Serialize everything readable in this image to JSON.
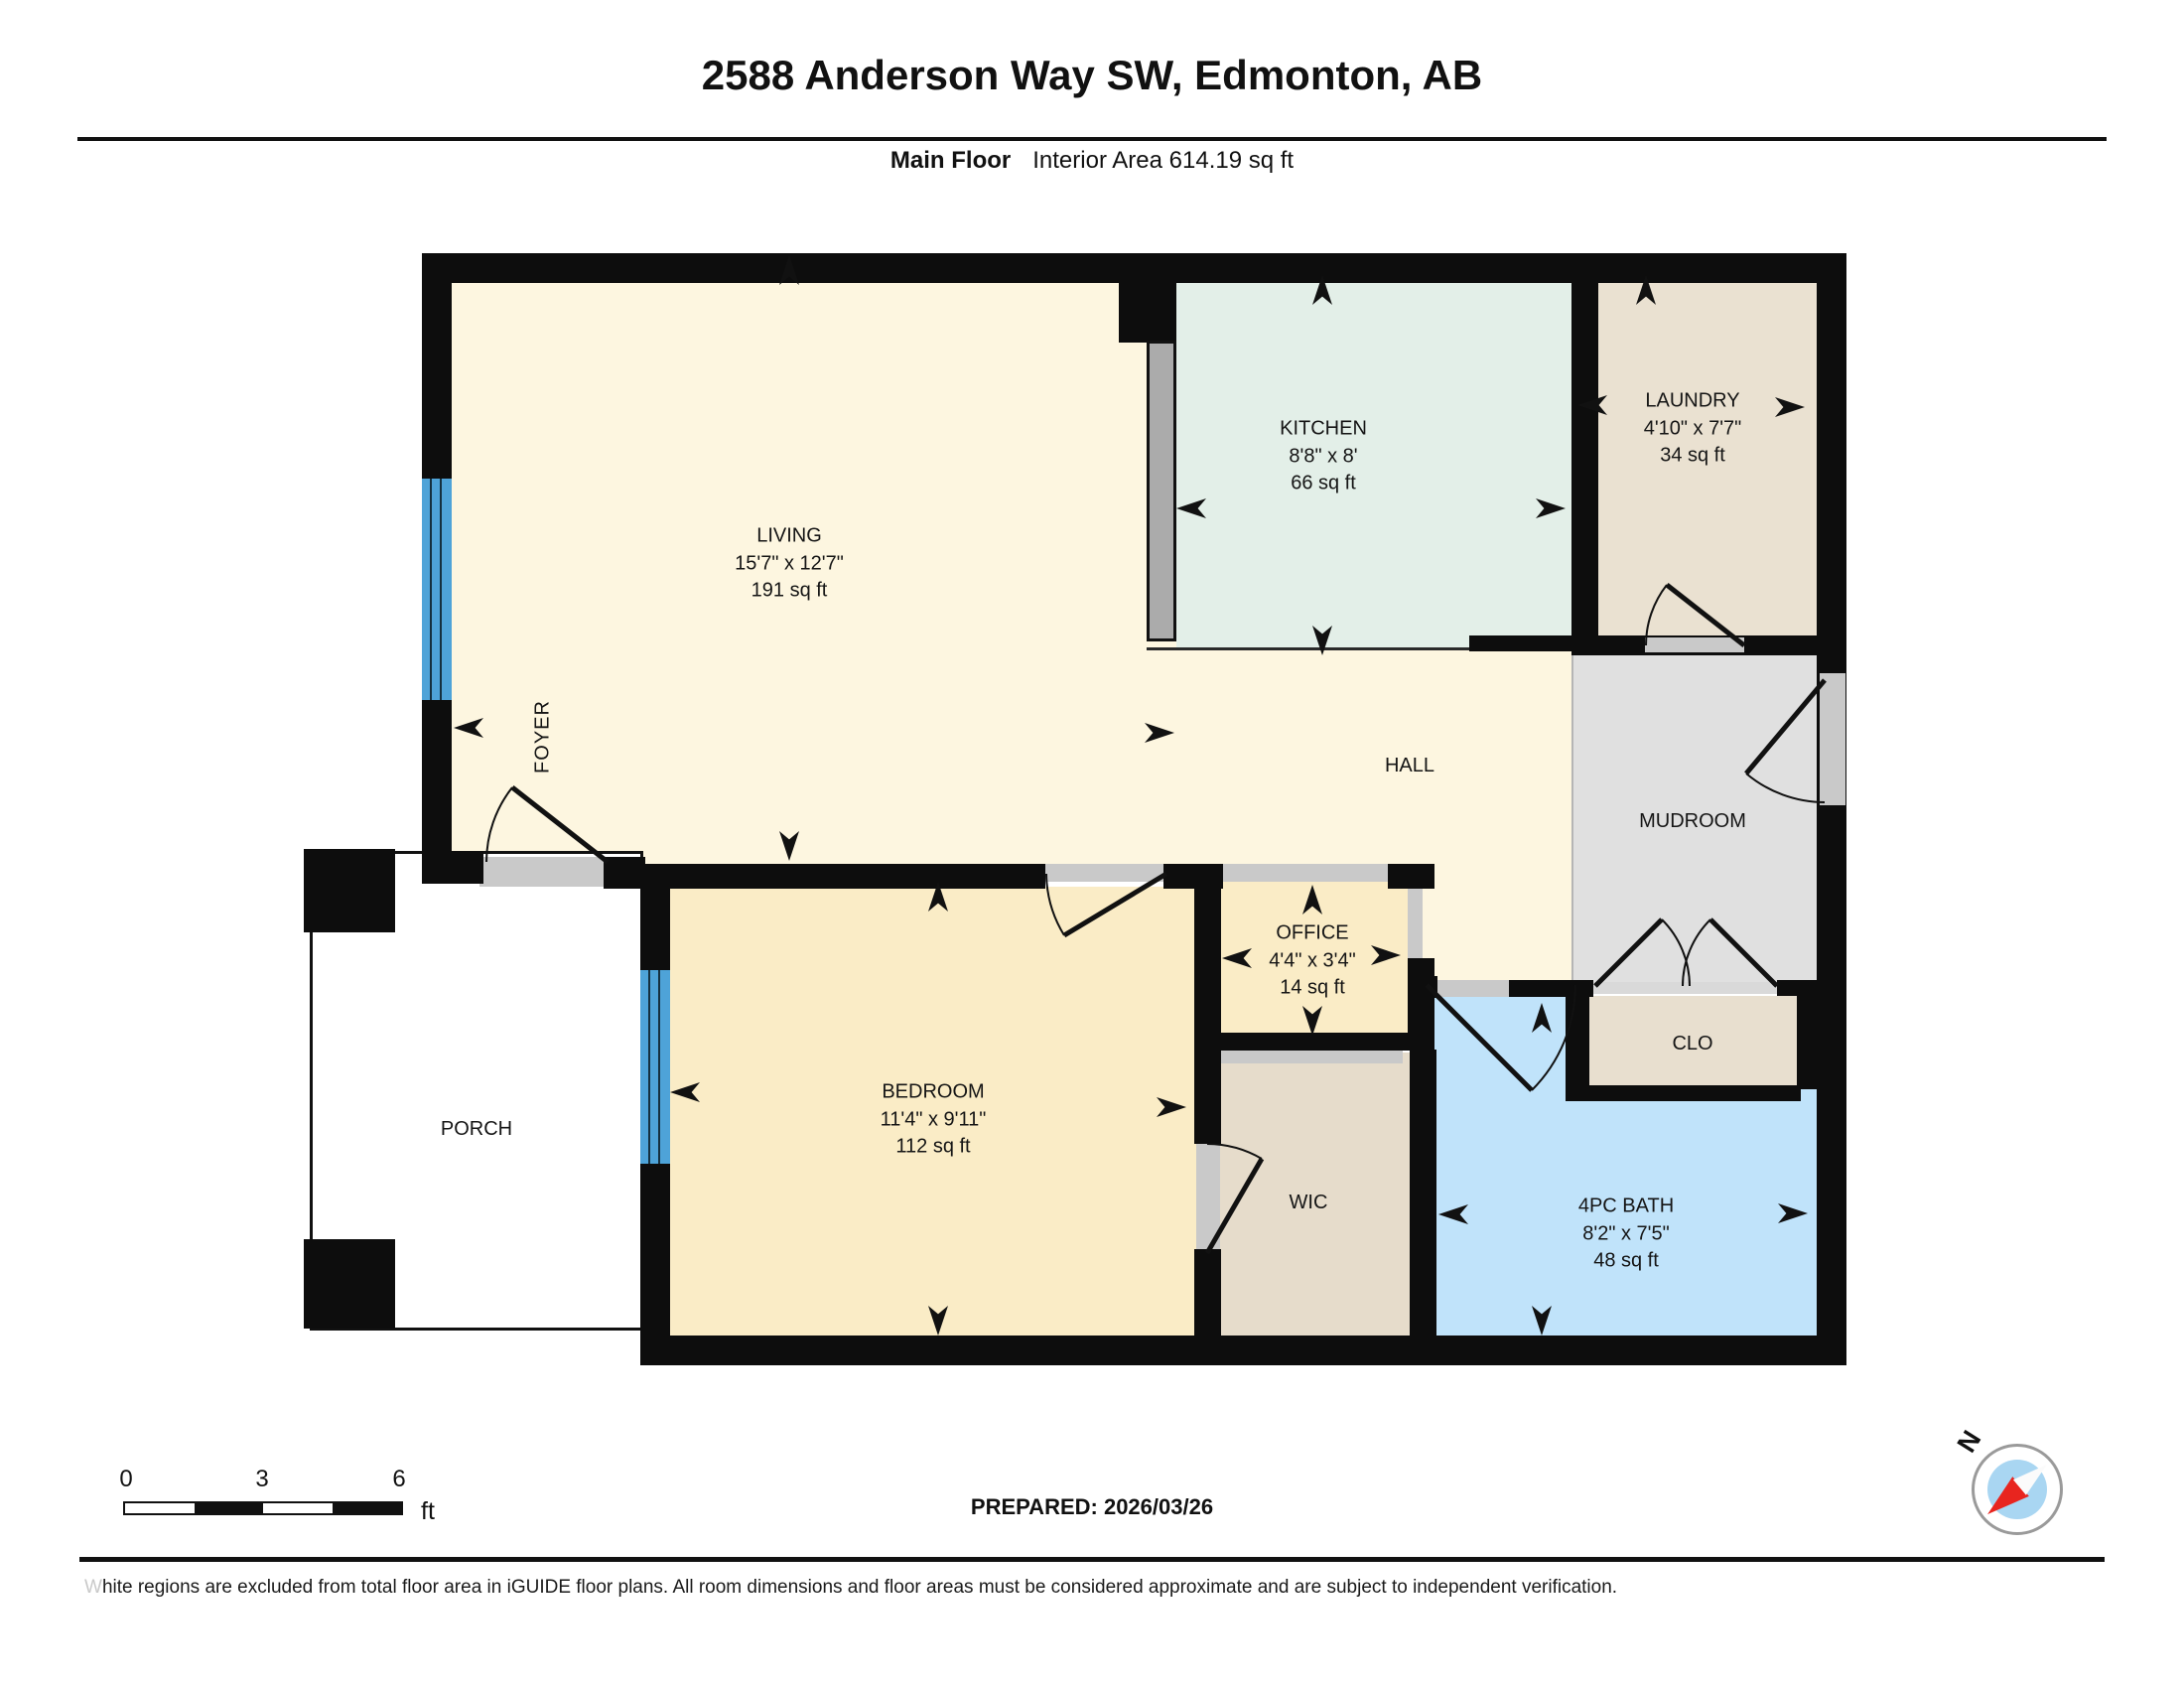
{
  "header": {
    "title": "2588 Anderson Way SW, Edmonton, AB",
    "floor_label": "Main Floor",
    "area_label": "Interior Area 614.19 sq ft"
  },
  "rooms": {
    "living": {
      "name": "LIVING",
      "dims": "15'7\" x 12'7\"",
      "area": "191 sq ft"
    },
    "kitchen": {
      "name": "KITCHEN",
      "dims": "8'8\" x 8'",
      "area": "66 sq ft"
    },
    "laundry": {
      "name": "LAUNDRY",
      "dims": "4'10\" x 7'7\"",
      "area": "34 sq ft"
    },
    "office": {
      "name": "OFFICE",
      "dims": "4'4\" x 3'4\"",
      "area": "14 sq ft"
    },
    "bedroom": {
      "name": "BEDROOM",
      "dims": "11'4\" x 9'11\"",
      "area": "112 sq ft"
    },
    "bath": {
      "name": "4PC BATH",
      "dims": "8'2\" x 7'5\"",
      "area": "48 sq ft"
    },
    "hall": {
      "name": "HALL"
    },
    "mudroom": {
      "name": "MUDROOM"
    },
    "foyer": {
      "name": "FOYER"
    },
    "wic": {
      "name": "WIC"
    },
    "clo": {
      "name": "CLO"
    },
    "porch": {
      "name": "PORCH"
    }
  },
  "scale_bar": {
    "tick_0": "0",
    "tick_3": "3",
    "tick_6": "6",
    "unit": "ft"
  },
  "prepared_label": "PREPARED: 2026/03/26",
  "compass_label": "N",
  "disclaimer": {
    "first_letter": "W",
    "rest": "hite regions are excluded from total floor area in iGUIDE floor plans. All room dimensions and floor areas must be considered approximate and are subject to independent verification."
  },
  "colors": {
    "wall": "#0d0d0d",
    "living_hall_cream": "#fdf6e0",
    "kitchen_mint": "#e3efe8",
    "laundry_beige": "#eae1d1",
    "mudroom_gray": "#e0e0e0",
    "bedroom_office_wheat": "#faecc6",
    "bath_blue": "#c0e3fa",
    "window_blue": "#4ea3d8",
    "door_sill_gray": "#c9c9c9",
    "compass_red": "#e8251f",
    "compass_blue": "#a9d6f2"
  }
}
